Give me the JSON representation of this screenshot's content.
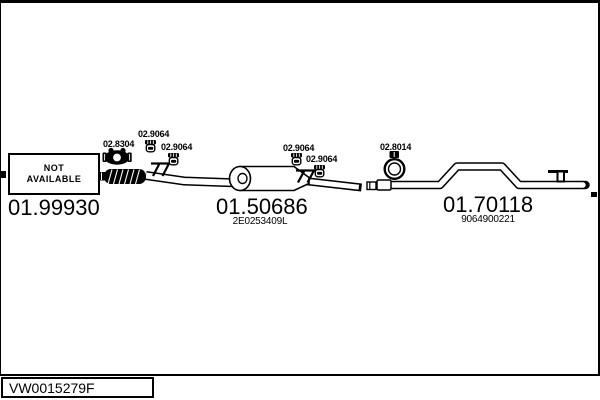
{
  "diagram": {
    "not_available_box": {
      "line1": "NOT",
      "line2": "AVAILABLE"
    },
    "sections": [
      {
        "part_number": "01.99930",
        "oem_number": ""
      },
      {
        "part_number": "01.50686",
        "oem_number": "2E0253409L"
      },
      {
        "part_number": "01.70118",
        "oem_number": "9064900221"
      }
    ],
    "fittings": [
      {
        "label": "02.8304",
        "type": "exhaust-clamp"
      },
      {
        "label": "02.9064",
        "type": "rubber-hanger"
      },
      {
        "label": "02.9064",
        "type": "rubber-hanger"
      },
      {
        "label": "02.9064",
        "type": "rubber-hanger"
      },
      {
        "label": "02.9064",
        "type": "rubber-hanger"
      },
      {
        "label": "02.8014",
        "type": "exhaust-clamp"
      }
    ],
    "colors": {
      "line": "#000000",
      "background": "#ffffff"
    }
  },
  "footer": {
    "reference_code": "VW0015279F"
  }
}
